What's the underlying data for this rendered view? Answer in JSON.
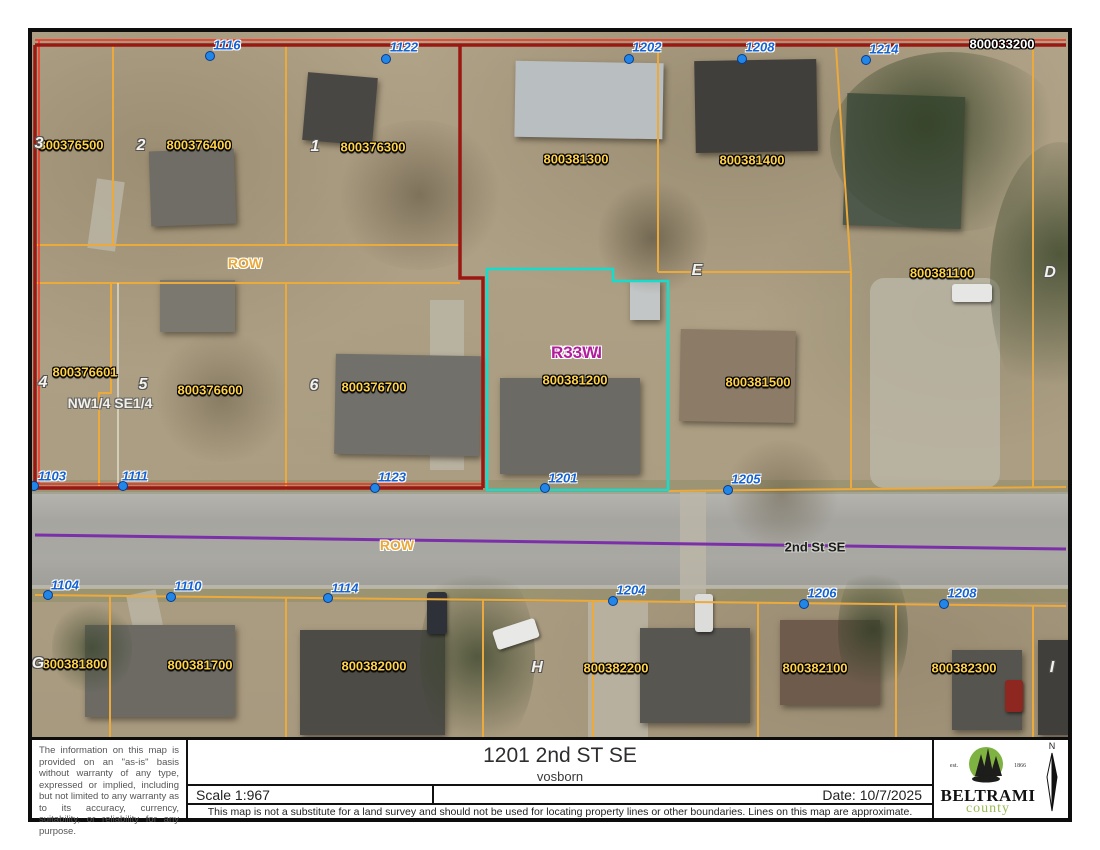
{
  "map": {
    "colors": {
      "parcel_line": "#edaa3c",
      "boundary_red": "#9b1712",
      "boundary_red_bright": "#ff2a1a",
      "highlight_cyan": "#17dccb",
      "centerline_purple": "#7b2fa8",
      "point_blue": "#2086e8",
      "label_yellow": "#ffd24a",
      "label_blue": "#1563d2",
      "label_magenta": "#b11e9b"
    },
    "corner_parcel": {
      "id": "800033200",
      "x": 970,
      "y": 12
    },
    "row_label_top": {
      "text": "ROW",
      "x": 213,
      "y": 231
    },
    "row_label_road": {
      "text": "ROW",
      "x": 365,
      "y": 513
    },
    "street_label": {
      "text": "2nd St SE",
      "x": 783,
      "y": 515
    },
    "plss_label": {
      "text": "NW1/4 SE1/4",
      "x": 78,
      "y": 371
    },
    "township_label": {
      "line1": "T146N",
      "line2": "R33W",
      "x": 519,
      "y": 311
    },
    "address_points": [
      {
        "num": "1116",
        "dot": [
          178,
          24
        ],
        "label": [
          195,
          13
        ]
      },
      {
        "num": "1122",
        "dot": [
          354,
          27
        ],
        "label": [
          372,
          15
        ]
      },
      {
        "num": "1202",
        "dot": [
          597,
          27
        ],
        "label": [
          615,
          15
        ]
      },
      {
        "num": "1208",
        "dot": [
          710,
          27
        ],
        "label": [
          728,
          15
        ]
      },
      {
        "num": "1214",
        "dot": [
          834,
          28
        ],
        "label": [
          852,
          17
        ]
      },
      {
        "num": "1103",
        "dot": [
          2,
          454
        ],
        "label": [
          20,
          444
        ]
      },
      {
        "num": "1111",
        "dot": [
          91,
          454
        ],
        "label": [
          103,
          444
        ]
      },
      {
        "num": "1123",
        "dot": [
          343,
          456
        ],
        "label": [
          360,
          445
        ]
      },
      {
        "num": "1201",
        "dot": [
          513,
          456
        ],
        "label": [
          531,
          446
        ]
      },
      {
        "num": "1205",
        "dot": [
          696,
          458
        ],
        "label": [
          714,
          447
        ]
      },
      {
        "num": "1104",
        "dot": [
          16,
          563
        ],
        "label": [
          33,
          553
        ]
      },
      {
        "num": "1110",
        "dot": [
          139,
          565
        ],
        "label": [
          156,
          554
        ]
      },
      {
        "num": "1114",
        "dot": [
          296,
          566
        ],
        "label": [
          313,
          556
        ]
      },
      {
        "num": "1204",
        "dot": [
          581,
          569
        ],
        "label": [
          599,
          558
        ]
      },
      {
        "num": "1206",
        "dot": [
          772,
          572
        ],
        "label": [
          790,
          561
        ]
      },
      {
        "num": "1208",
        "dot": [
          912,
          572
        ],
        "label": [
          930,
          561
        ]
      }
    ],
    "parcel_labels": [
      {
        "id": "800376500",
        "x": 39,
        "y": 113
      },
      {
        "id": "800376400",
        "x": 167,
        "y": 113
      },
      {
        "id": "800376300",
        "x": 341,
        "y": 115
      },
      {
        "id": "800381300",
        "x": 544,
        "y": 127
      },
      {
        "id": "800381400",
        "x": 720,
        "y": 128
      },
      {
        "id": "800381100",
        "x": 910,
        "y": 241
      },
      {
        "id": "800376601",
        "x": 53,
        "y": 340
      },
      {
        "id": "800376600",
        "x": 178,
        "y": 358
      },
      {
        "id": "800376700",
        "x": 342,
        "y": 355
      },
      {
        "id": "800381200",
        "x": 543,
        "y": 348
      },
      {
        "id": "800381500",
        "x": 726,
        "y": 350
      },
      {
        "id": "800381800",
        "x": 43,
        "y": 632
      },
      {
        "id": "800381700",
        "x": 168,
        "y": 633
      },
      {
        "id": "800382000",
        "x": 342,
        "y": 634
      },
      {
        "id": "800382200",
        "x": 584,
        "y": 636
      },
      {
        "id": "800382100",
        "x": 783,
        "y": 636
      },
      {
        "id": "800382300",
        "x": 932,
        "y": 636
      }
    ],
    "lot_numbers": [
      {
        "n": "3",
        "x": 7,
        "y": 112
      },
      {
        "n": "2",
        "x": 109,
        "y": 114
      },
      {
        "n": "1",
        "x": 283,
        "y": 115
      },
      {
        "n": "4",
        "x": 11,
        "y": 351
      },
      {
        "n": "5",
        "x": 111,
        "y": 353
      },
      {
        "n": "6",
        "x": 282,
        "y": 354
      }
    ],
    "block_letters": [
      {
        "n": "E",
        "x": 665,
        "y": 239
      },
      {
        "n": "D",
        "x": 1018,
        "y": 241
      },
      {
        "n": "G",
        "x": 6,
        "y": 632
      },
      {
        "n": "H",
        "x": 505,
        "y": 636
      },
      {
        "n": "I",
        "x": 1020,
        "y": 636
      }
    ]
  },
  "titleblock": {
    "title": "1201 2nd ST SE",
    "subtitle": "vosborn",
    "scale": "Scale 1:967",
    "date": "Date: 10/7/2025",
    "disclaimer_side": "The information on this map is provided on an \"as-is\" basis without warranty of any type, expressed or implied, including but not limited to any warranty as to its accuracy, currency, suitability, or reliability for any purpose.",
    "disclaimer_bottom": "This map is not a substitute for a land survey and should not be used for locating property lines or other boundaries.  Lines on this map are approximate.",
    "logo": {
      "est": "est.",
      "year": "1866",
      "name_top": "BELTRAMI",
      "name_bottom": "county"
    },
    "north_label": "N"
  }
}
